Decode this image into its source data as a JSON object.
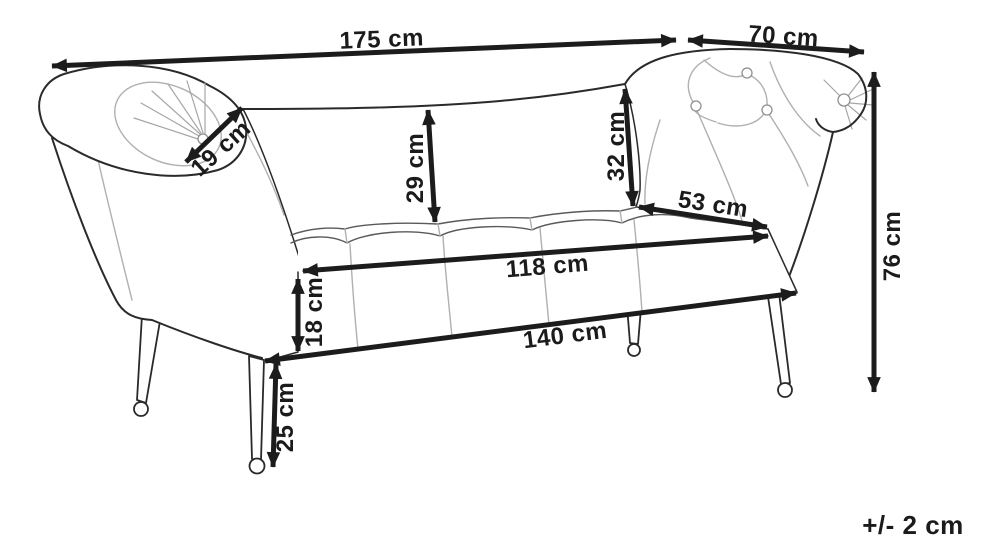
{
  "diagram": {
    "type": "furniture-dimension-drawing",
    "subject": "chaise lounge bench with scroll armrests and ball feet",
    "background_color": "#ffffff",
    "line_color": "#1c1c1c",
    "tolerance_note": "+/- 2 cm",
    "dims": {
      "total_width": {
        "label": "175 cm",
        "value_cm": 175,
        "measures": "overall width (left end of left armrest to start of right armrest)"
      },
      "armrest_width": {
        "label": "70 cm",
        "value_cm": 70,
        "measures": "right armrest section width"
      },
      "armrest_roll": {
        "label": "19 cm",
        "value_cm": 19,
        "measures": "left armrest roll diameter (diagonal)"
      },
      "backrest_left_height": {
        "label": "29 cm",
        "value_cm": 29,
        "measures": "backrest height above seat, left side"
      },
      "backrest_right_height": {
        "label": "32 cm",
        "value_cm": 32,
        "measures": "backrest height above seat, right side"
      },
      "seat_depth": {
        "label": "53 cm",
        "value_cm": 53,
        "measures": "seat depth (right side, back to front)"
      },
      "seat_width": {
        "label": "118 cm",
        "value_cm": 118,
        "measures": "seat width along front top edge"
      },
      "seat_thickness": {
        "label": "18 cm",
        "value_cm": 18,
        "measures": "seat cushion thickness"
      },
      "base_width": {
        "label": "140 cm",
        "value_cm": 140,
        "measures": "base width along front bottom edge"
      },
      "leg_height": {
        "label": "25 cm",
        "value_cm": 25,
        "measures": "leg height"
      },
      "total_height": {
        "label": "76 cm",
        "value_cm": 76,
        "measures": "overall height"
      }
    }
  }
}
